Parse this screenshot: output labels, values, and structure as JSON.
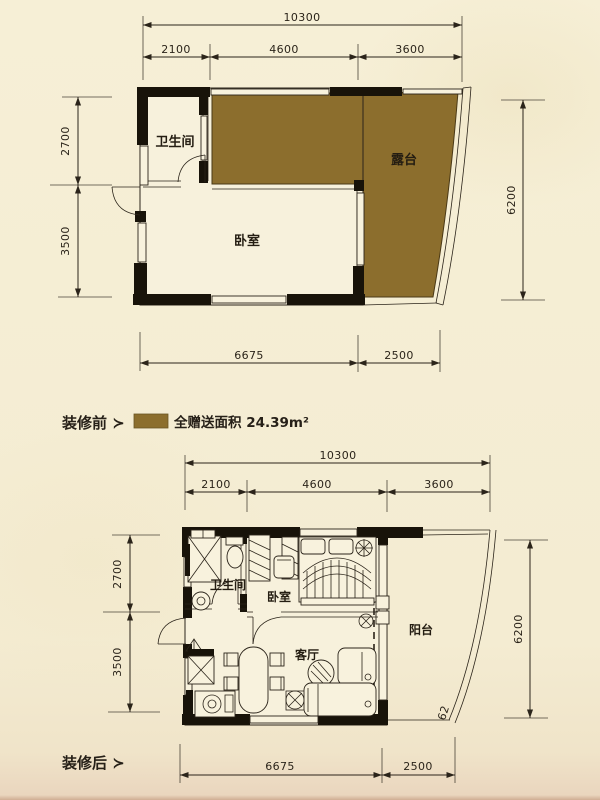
{
  "meta": {
    "bg": "#f5eed5",
    "ink": "#2b241a",
    "wall_black": "#181309",
    "gift_brown": "#8c6e2d"
  },
  "plan_before": {
    "section_label": "装修前 ≻",
    "rooms": {
      "bathroom": "卫生间",
      "bedroom": "卧室",
      "terrace": "露台"
    },
    "dims": {
      "total_width": "10300",
      "w1": "2100",
      "w2": "4600",
      "w3": "3600",
      "h1": "2700",
      "h2": "3500",
      "right_height": "6200",
      "b1": "6675",
      "b2": "2500"
    }
  },
  "legend": {
    "swatch_color": "#8c6e2d",
    "label": "全赠送面积 24.39m²"
  },
  "plan_after": {
    "section_label": "装修后 ≻",
    "rooms": {
      "bathroom": "卫生间",
      "bedroom": "卧室",
      "living": "客厅",
      "balcony": "阳台"
    },
    "dims": {
      "total_width": "10300",
      "w1": "2100",
      "w2": "4600",
      "w3": "3600",
      "h1": "2700",
      "h2": "3500",
      "right_height": "6200",
      "b1": "6675",
      "b2": "2500",
      "curve_partial": "62"
    }
  }
}
